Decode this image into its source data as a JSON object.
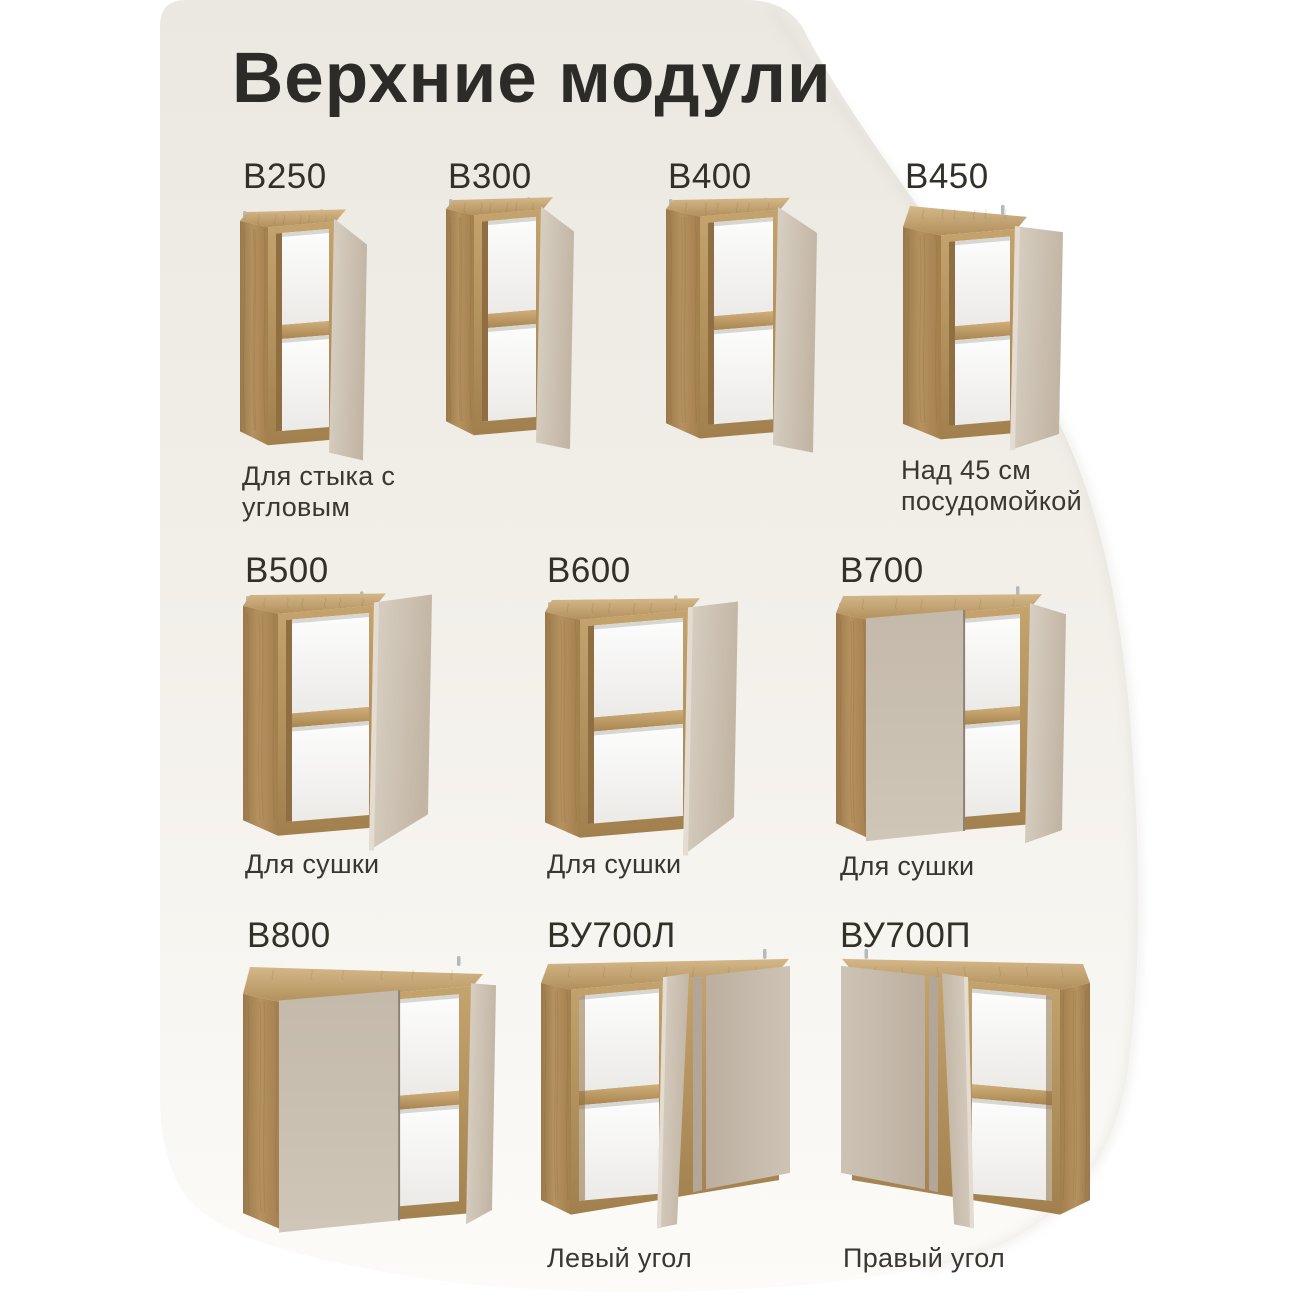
{
  "page": {
    "title": "Верхние модули"
  },
  "modules": [
    {
      "id": "b250",
      "label": "В250",
      "caption": "Для стыка с угловым"
    },
    {
      "id": "b300",
      "label": "В300",
      "caption": ""
    },
    {
      "id": "b400",
      "label": "В400",
      "caption": ""
    },
    {
      "id": "b450",
      "label": "В450",
      "caption": "Над 45 см посудомойкой"
    },
    {
      "id": "b500",
      "label": "В500",
      "caption": "Для сушки"
    },
    {
      "id": "b600",
      "label": "В600",
      "caption": "Для сушки"
    },
    {
      "id": "b700",
      "label": "В700",
      "caption": "Для сушки"
    },
    {
      "id": "b800",
      "label": "В800",
      "caption": ""
    },
    {
      "id": "bu700l",
      "label": "ВУ700Л",
      "caption": "Левый угол"
    },
    {
      "id": "bu700p",
      "label": "ВУ700П",
      "caption": "Правый угол"
    }
  ],
  "colors": {
    "background": "#ffffff",
    "panel_top": "#ebe8e1",
    "panel_bottom": "#fcfbf8",
    "wood": "#b3905c",
    "facade_beige": "#c9beb0",
    "text": "#2d2b27"
  }
}
